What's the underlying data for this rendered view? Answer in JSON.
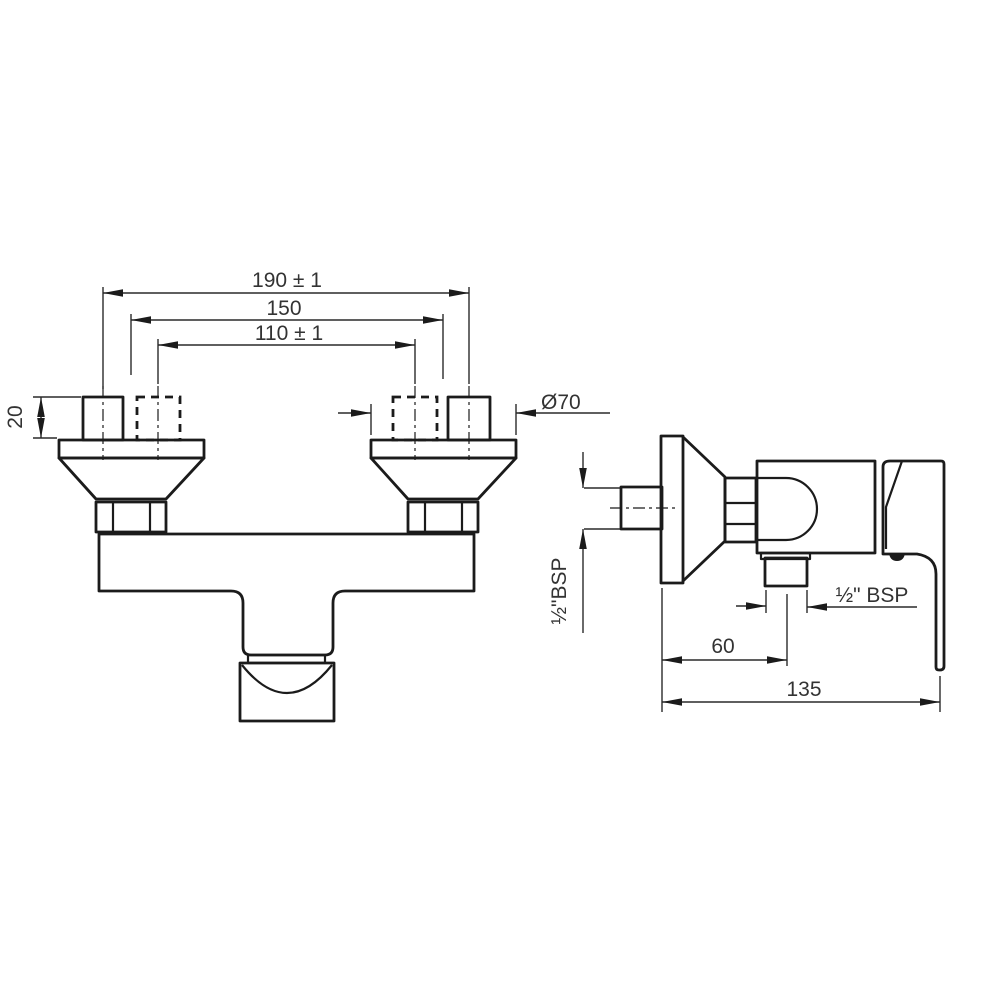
{
  "drawing": {
    "front_view": {
      "dim_width_outer": "190 ± 1",
      "dim_flange_centers": "150",
      "dim_width_inner": "110 ± 1",
      "dim_connector_height": "20",
      "dim_flange_diameter": "Ø70"
    },
    "side_view": {
      "dim_inlet_thread": "½\"BSP",
      "dim_outlet_thread": "½\" BSP",
      "dim_outlet_offset": "60",
      "dim_total_depth": "135"
    },
    "colors": {
      "line": "#1b1b1b",
      "background": "#ffffff"
    }
  }
}
